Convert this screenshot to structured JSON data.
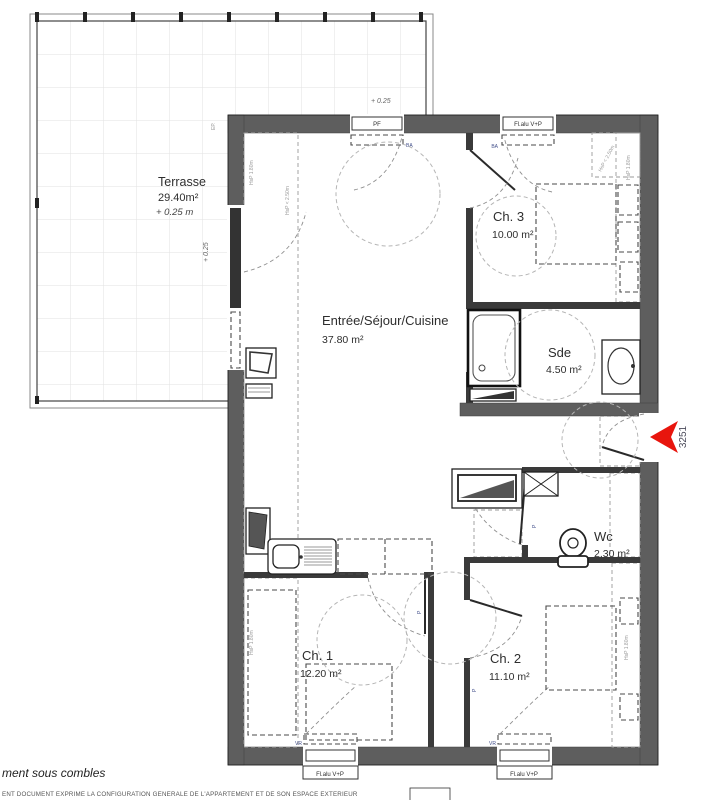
{
  "unit": {
    "number": "3251"
  },
  "terrace": {
    "name": "Terrasse",
    "area": "29.40m²",
    "level": "+ 0.25 m",
    "level_mark": "+ 0.25",
    "level_side": "+ 0.25",
    "ep": "EP."
  },
  "rooms": {
    "living": {
      "name": "Entrée/Séjour/Cuisine",
      "area": "37.80 m²"
    },
    "ch3": {
      "name": "Ch. 3",
      "area": "10.00 m²"
    },
    "sde": {
      "name": "Sde",
      "area": "4.50 m²"
    },
    "wc": {
      "name": "Wc",
      "area": "2.30 m²"
    },
    "ch1": {
      "name": "Ch. 1",
      "area": "12.20 m²"
    },
    "ch2": {
      "name": "Ch. 2",
      "area": "11.10 m²"
    }
  },
  "openings": {
    "pf": "PF",
    "window": "Fl.alu V+P",
    "ba": "BA",
    "vr": "VR",
    "door": "P"
  },
  "annotations": {
    "hsp_250": "HsP < 2.50m",
    "hsp_180": "HsP 1.80m"
  },
  "footer": {
    "caption": "ment sous combles",
    "legal": "ENT DOCUMENT EXPRIME LA CONFIGURATION GENERALE DE L'APPARTEMENT ET DE SON ESPACE EXTERIEUR"
  },
  "colors": {
    "wall": "#5e5e5e",
    "marker_red": "#e8150d",
    "hatch": "#cfcfcf",
    "grid": "#e2e2e2",
    "label_blue": "#44518c"
  }
}
